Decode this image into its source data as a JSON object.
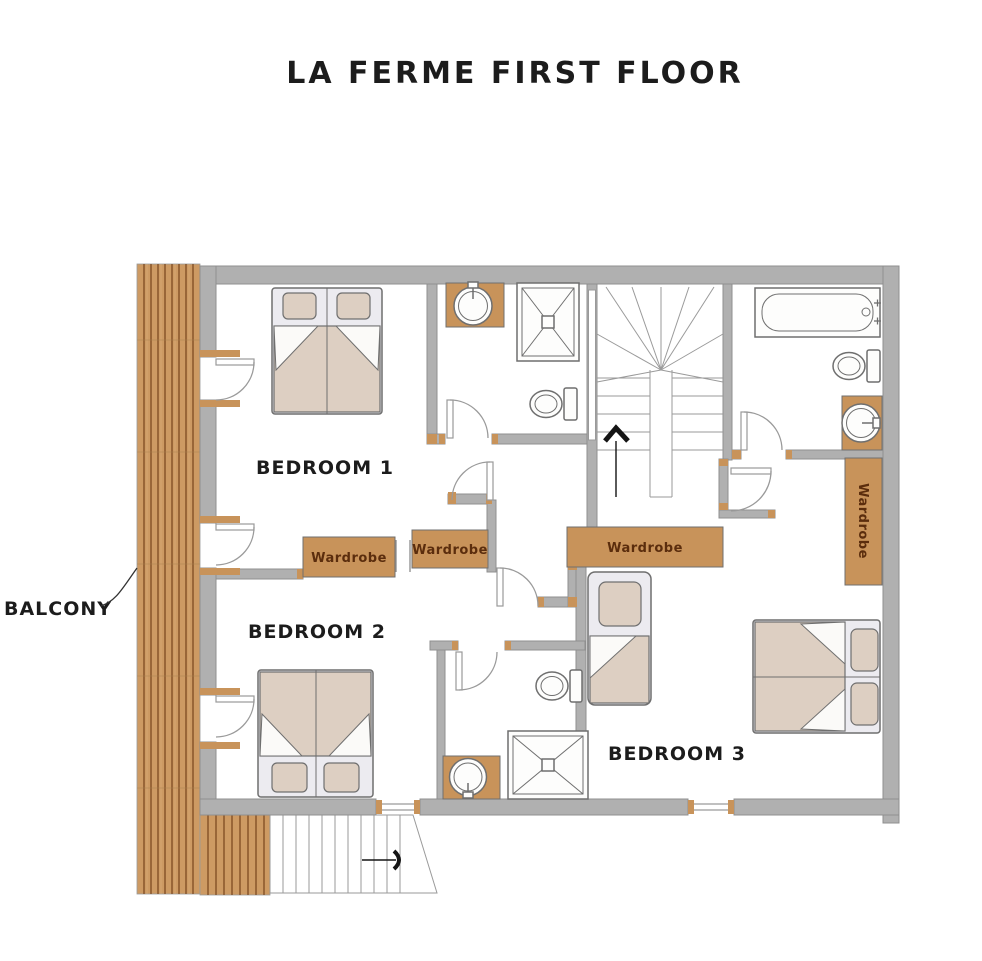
{
  "title": "LA FERME FIRST FLOOR",
  "labels": {
    "balcony": "BALCONY",
    "bedroom1": "BEDROOM 1",
    "bedroom2": "BEDROOM 2",
    "bedroom3": "BEDROOM 3"
  },
  "wardrobes": {
    "bedroom1_a": "Wardrobe",
    "bedroom1_b": "Wardrobe",
    "hall": "Wardrobe",
    "bedroom3_tall": "Wardrobe"
  },
  "fixtures": {
    "bedroom1_bed": "double-bed",
    "bedroom2_bed": "double-bed",
    "bedroom3_bed": "double-bed",
    "bedroom3_single_bed": "single-bed",
    "bathroom_top_middle": [
      "wash-basin",
      "shower",
      "toilet"
    ],
    "bathroom_bottom_middle": [
      "toilet",
      "shower",
      "wash-basin"
    ],
    "bathroom_top_right": [
      "bathtub",
      "toilet",
      "wash-basin"
    ],
    "stairs": "staircase-with-up-arrow",
    "exterior": [
      "balcony-decking",
      "exterior-steps-down-arrow"
    ]
  },
  "colors": {
    "wall": "#b0b0b0",
    "wall-stroke": "#8f8f8f",
    "wood": "#c8935a",
    "wood-dark": "#7d4b22",
    "deck-light": "#dcae7c",
    "linen": "#ddcfc2",
    "bed-base": "#ecebf0",
    "fix": "#6f6f6f",
    "label": "#1c1c1c",
    "wtext": "#5b2d0d"
  }
}
